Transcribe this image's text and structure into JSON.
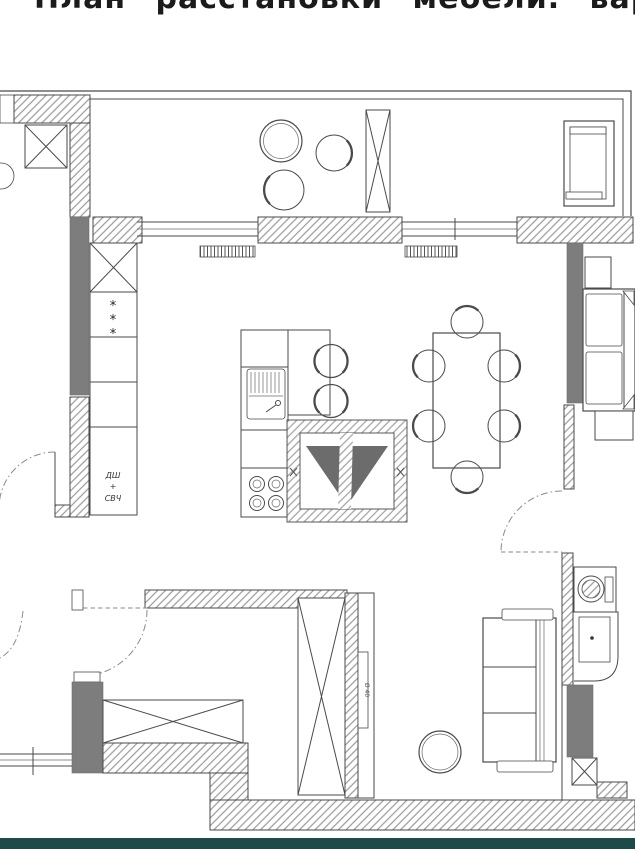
{
  "page": {
    "title": "План расстановки мебели. вар 3"
  },
  "plan": {
    "labels": {
      "fridge_marks": [
        "*",
        "*",
        "*"
      ],
      "oven_line1": "ДШ",
      "oven_line2": "+",
      "oven_line3": "СВЧ",
      "tv_size_label": "Ø 40"
    },
    "colors": {
      "wall_solid_fill": "#7d7d7d",
      "line": "#4a4a4a",
      "hatch_line": "#9a9a9a",
      "footer_bar": "#1d4b47",
      "watermark_triangle": "#606060"
    }
  }
}
